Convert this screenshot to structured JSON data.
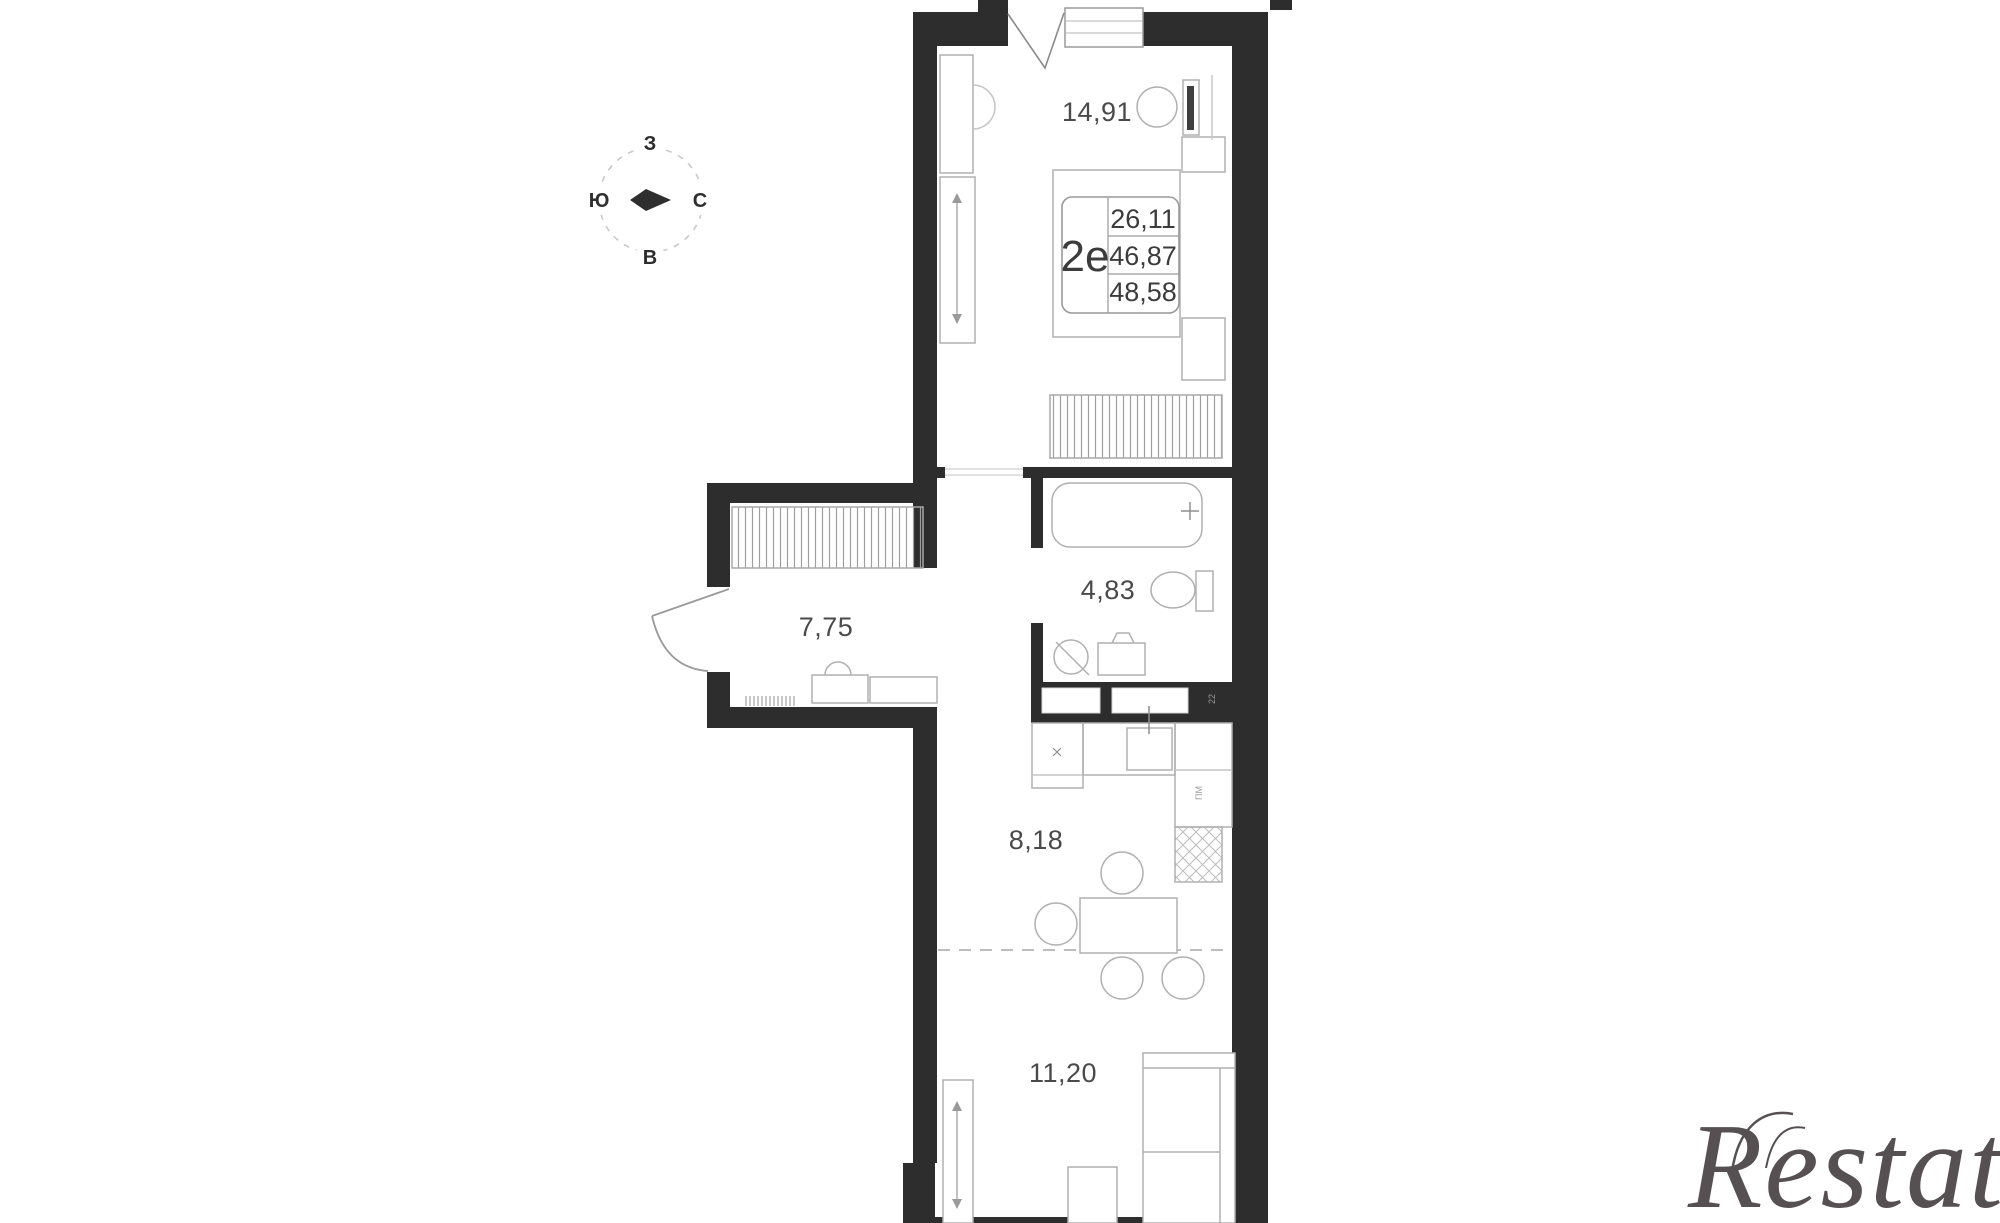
{
  "compass": {
    "west": "З",
    "south": "Ю",
    "north": "С",
    "east": "В"
  },
  "apartment_card": {
    "type_label": "2е",
    "areas": [
      "26,11",
      "46,87",
      "48,58"
    ]
  },
  "rooms": [
    {
      "name": "bedroom",
      "area_label": "14,91"
    },
    {
      "name": "bathroom",
      "area_label": "4,83"
    },
    {
      "name": "hallway",
      "area_label": "7,75"
    },
    {
      "name": "kitchen",
      "area_label": "8,18"
    },
    {
      "name": "living-room",
      "area_label": "11,20"
    }
  ],
  "tiny_labels": {
    "appliance": "ПМ",
    "niche": "22"
  },
  "watermark": {
    "text": "Restate",
    "color": "#575052"
  },
  "colors": {
    "wall": "#2d2d2d",
    "furniture_line": "#b0b0b0",
    "hatch_line": "#9f9f9f",
    "label_text": "#474747",
    "compass_ink": "#2e2e2e",
    "dash_line": "#bdbdbd"
  }
}
